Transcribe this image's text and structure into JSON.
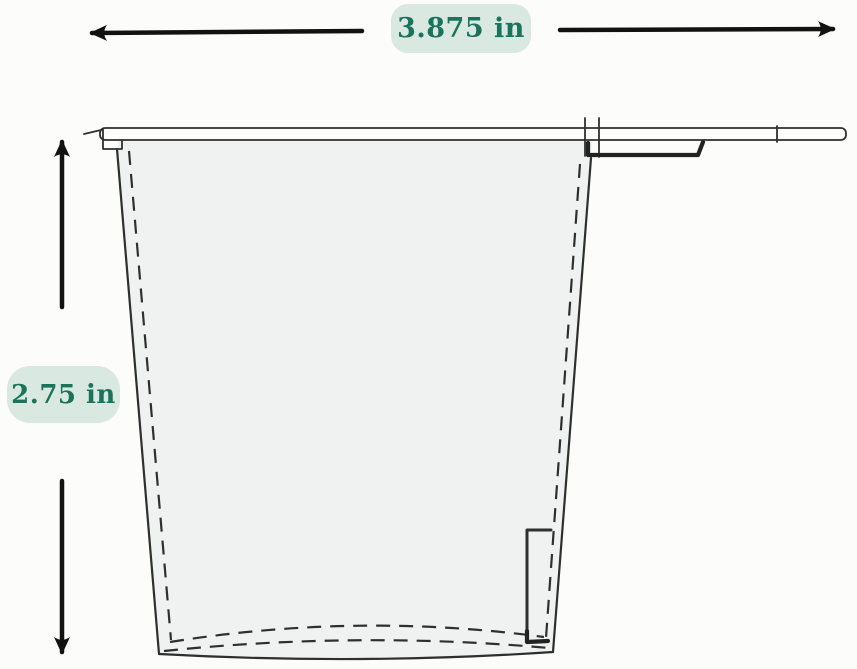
{
  "diagram": {
    "width_label": "3.875 in",
    "height_label": "2.75 in",
    "colors": {
      "label_bg": "#d9e8e1",
      "label_text": "#1a735a",
      "arrow": "#121212",
      "line": "#2f2f2f",
      "interior_fill": "#f0f2f1",
      "page_bg": "#fcfcfb"
    },
    "icons": {
      "width_arrow_left": "arrow-left-icon",
      "width_arrow_right": "arrow-right-icon",
      "height_arrow_up": "arrow-up-icon",
      "height_arrow_down": "arrow-down-icon"
    }
  }
}
